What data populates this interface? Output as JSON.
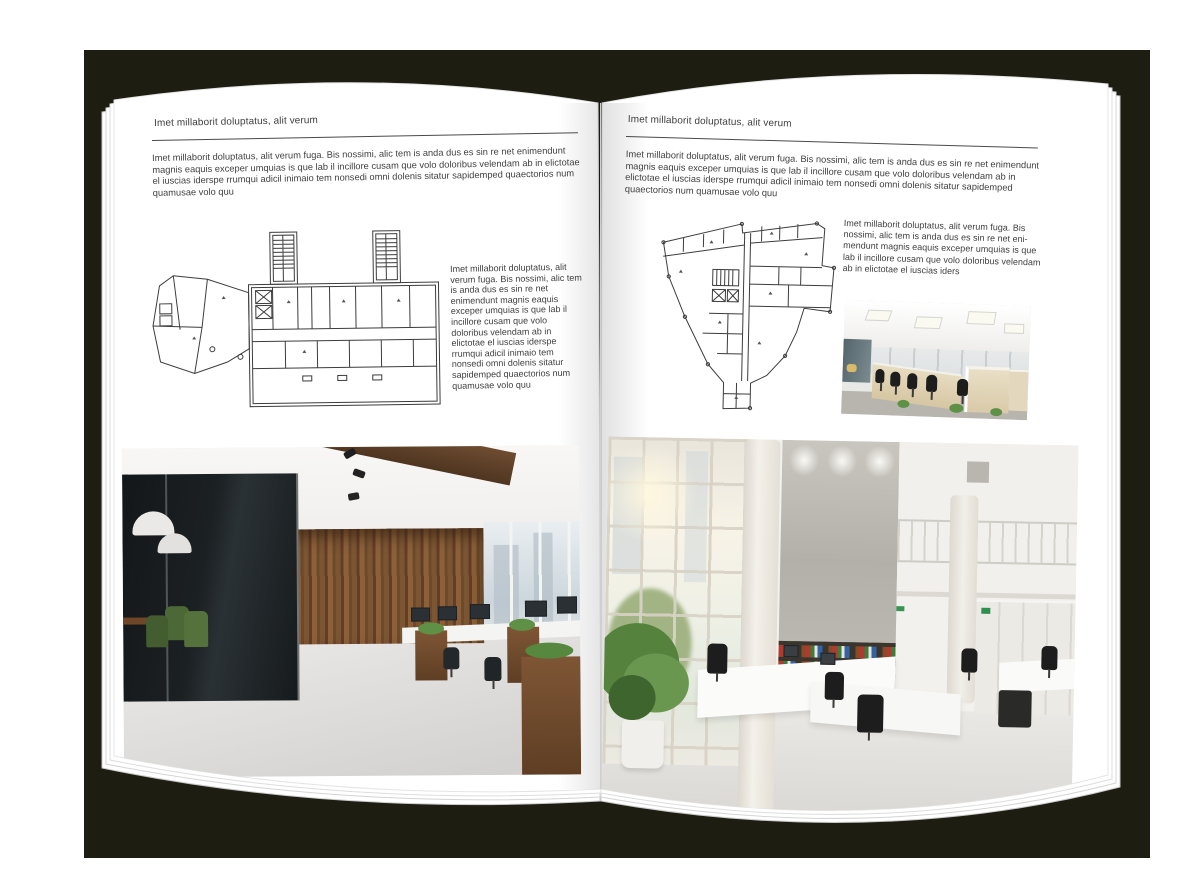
{
  "spread": {
    "left_page": {
      "header": "Imet millaborit doluptatus, alit verum",
      "intro": "Imet millaborit doluptatus, alit verum fuga. Bis nossimi, alic tem is anda dus es sin re net enimendunt magnis eaquis exceper umquias is que lab il incillore cusam que volo doloribus velendam ab in elictotae el iuscias iderspe rrumqui adicil inimaio tem nonsedi omni dolenis sitatur sapidemped quaectorios num quamusae volo quu",
      "side_text": "Imet millaborit doluptatus, alit verum fuga. Bis nossimi, alic tem is anda dus es sin re net enimendunt magnis eaquis exceper umquias is que lab il incillore cusam que volo doloribus velendam ab in elictotae el iuscias iderspe rrumqui adicil inimaio tem nonsedi omni dolenis sitatur sapidemped quaectorios num quamusae volo quu"
    },
    "right_page": {
      "header": "Imet millaborit doluptatus, alit verum",
      "intro": "Imet millaborit doluptatus, alit verum fuga. Bis nossimi, alic tem is anda dus es sin re net enimendunt magnis eaquis exceper umquias is que lab il incillore cusam que volo doloribus velendam ab in elictotae el iuscias iderspe rrumqui adicil inimaio tem nonsedi omni dolenis sitatur sapidemped quaectorios num quamusae volo quu",
      "side_text": "Imet millaborit doluptatus, alit verum fuga. Bis nossimi, alic tem is anda dus es sin re net eni-mendunt magnis eaquis exceper umquias is que lab il incillore cusam que volo doloribus velendam ab in elictotae el iuscias iders"
    },
    "colors": {
      "cover": "#1d1d11",
      "page": "#ffffff",
      "text": "#3f3f3f",
      "rule": "#4a4a4a",
      "plan_lines": "#3c3c3c"
    }
  }
}
